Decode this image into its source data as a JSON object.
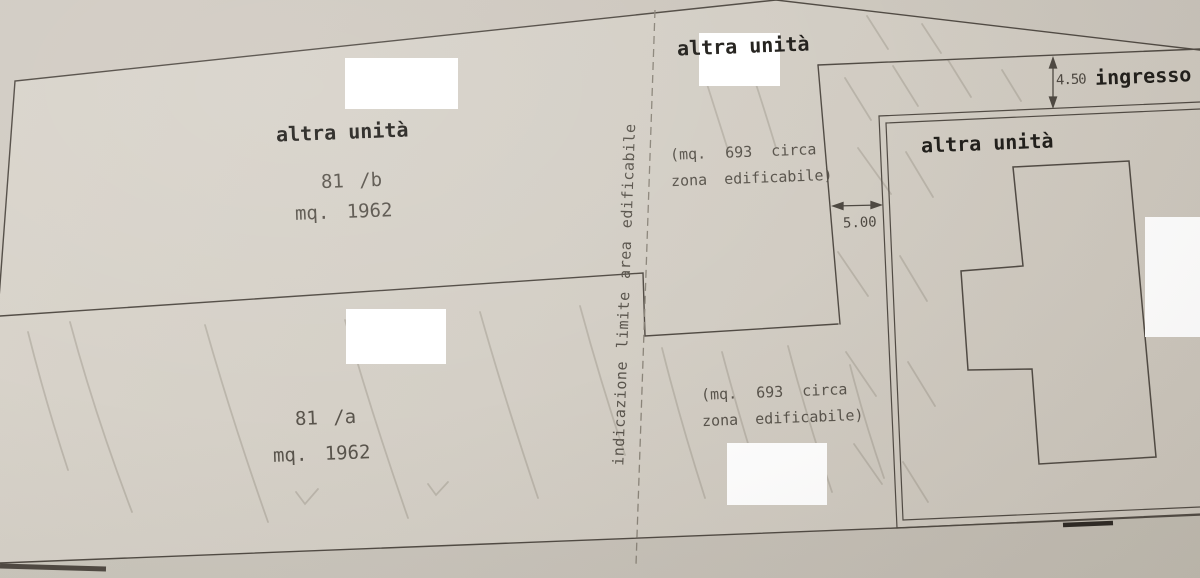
{
  "parcels": {
    "p81b": {
      "title": "altra unità",
      "code": "81 /b",
      "area": "mq. 1962"
    },
    "p81a": {
      "code": "81 /a",
      "area": "mq. 1962"
    },
    "zone_top": {
      "title": "altra unità",
      "area_line1": "(mq. 693 circa",
      "area_line2": "zona edificabile)"
    },
    "zone_bottom": {
      "area_line1": "(mq. 693 circa",
      "area_line2": "zona edificabile)"
    },
    "right_unit": {
      "title": "altra unità"
    }
  },
  "dimensions": {
    "entrance_height": "4.50",
    "entrance_label": "ingresso",
    "gap_width": "5.00"
  },
  "notes": {
    "boundary_note": "indicazione limite area edificabile"
  },
  "colors": {
    "paper": "#d4cfc6",
    "ink": "#514b44",
    "dashed_line": "#8b857a",
    "text_bold": "#22201c",
    "text_thin": "#59544c",
    "redaction": "#ffffff",
    "pencil": "#a29c90"
  }
}
